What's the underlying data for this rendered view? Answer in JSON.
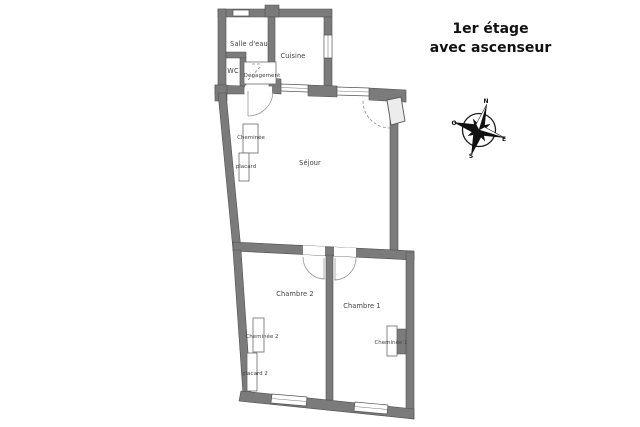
{
  "title": {
    "line1": "1er étage",
    "line2": "avec ascenseur"
  },
  "floorplan": {
    "rooms": {
      "salle_deau": "Salle d'eau",
      "cuisine": "Cuisine",
      "wc": "WC",
      "degagement": "Dégagement",
      "sejour": "Séjour",
      "chambre2": "Chambre 2",
      "chambre1": "Chambre 1"
    },
    "features": {
      "cheminee": "Cheminée",
      "placard": "placard",
      "cheminee2": "Cheminée 2",
      "placard2": "placard 2",
      "cheminee1": "Cheminée 1"
    }
  },
  "compass": {
    "north": "N",
    "south": "S",
    "east": "E",
    "west": "O"
  },
  "colors": {
    "wall": "#7b7b7b",
    "wall_outline": "#4f4f4f",
    "label": "#3d3d3d",
    "title": "#111111",
    "background": "#ffffff"
  }
}
